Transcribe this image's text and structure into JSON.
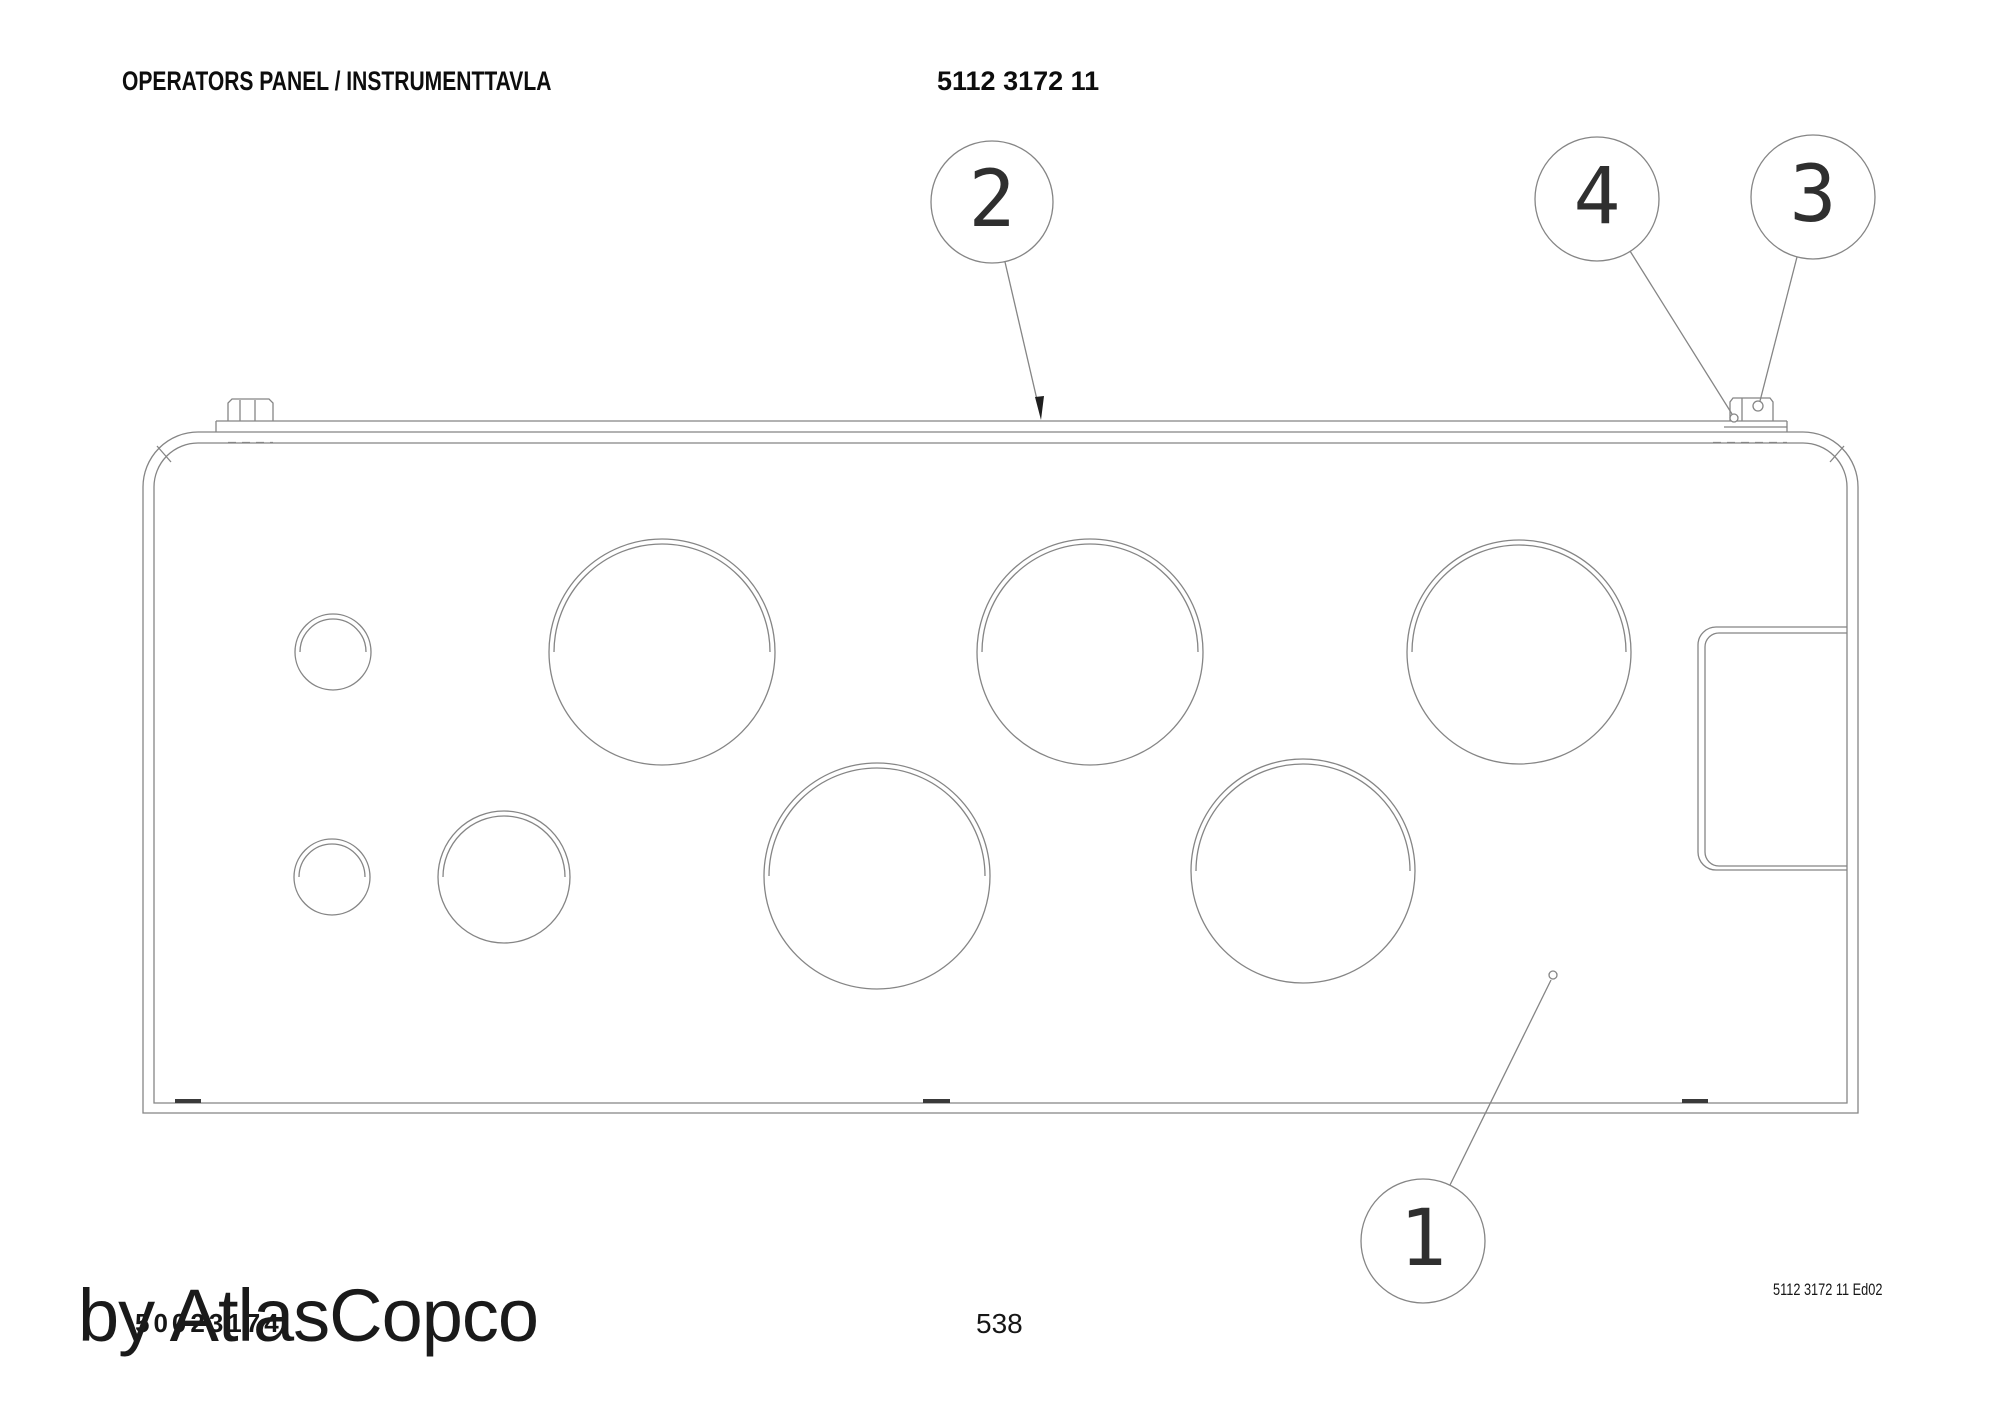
{
  "page": {
    "title": "OPERATORS PANEL / INSTRUMENTTAVLA",
    "part_number": "5112 3172 11",
    "page_number": "538",
    "edition_ref": "5112 3172 11 Ed02",
    "document_number": "50023174",
    "watermark": "by AtlasCopco"
  },
  "callouts": [
    {
      "label": "1"
    },
    {
      "label": "2"
    },
    {
      "label": "3"
    },
    {
      "label": "4"
    }
  ],
  "figure": {
    "view": "operators panel front view",
    "large_round_holes": 5,
    "medium_round_holes": 1,
    "small_round_holes": 2,
    "rectangular_cutouts": 1,
    "mounting_tabs": 2
  },
  "colors": {
    "line": "#858585",
    "dark": "#1f1f1f"
  }
}
